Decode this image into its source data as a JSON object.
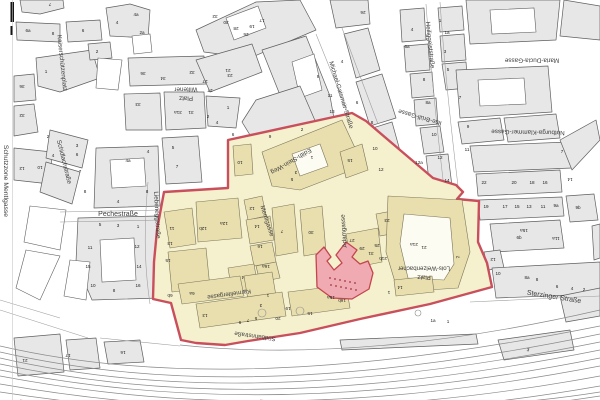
{
  "map": {
    "zone_name": "Schutzzone Mentlgasse",
    "colors": {
      "building_gray": "#e7e7e7",
      "outline": "#5f5f5f",
      "zone_fill": "#f5f1ce",
      "zone_building": "#e9dfae",
      "zone_outline": "#7b755a",
      "boundary": "#c94f5c",
      "highlight_fill": "#efaab2",
      "highlight_stroke": "#c4454f",
      "highlight_dot": "#a03540",
      "rail": "#8a8a8a",
      "label": "#3c3c3c"
    },
    "street_labels": [
      [
        "Schutzzone Mentlgasse",
        6,
        181,
        90,
        6.8
      ],
      [
        "Kaiserschützenplatz",
        62,
        63,
        84,
        6.3
      ],
      [
        "Wiltener",
        186,
        89,
        180,
        6.3
      ],
      [
        "Platz",
        186,
        98,
        180,
        6.3
      ],
      [
        "Schidlachstraße",
        64,
        162,
        76,
        6.3
      ],
      [
        "Pechestraße",
        118,
        214,
        0,
        7
      ],
      [
        "Liebeneggstraße",
        157,
        215,
        87,
        6.3
      ],
      [
        "Michael-Gaismair-Straße",
        341,
        95,
        73,
        6.3
      ],
      [
        "Heiliggeiststraße",
        430,
        45,
        84,
        6.3
      ],
      [
        "Maria-Ducia-Gasse",
        532,
        60,
        180,
        6.3
      ],
      [
        "Notburga-Klammer-Gasse",
        528,
        132,
        181,
        6.3
      ],
      [
        "Ilse-Brüll-Gasse",
        420,
        117,
        196,
        6.3
      ],
      [
        "Edith-Stein-Weg",
        291,
        161,
        150,
        6.3
      ],
      [
        "Mentlgasse",
        267,
        221,
        72,
        6.3
      ],
      [
        "Adamgasse",
        344,
        231,
        266,
        6.3
      ],
      [
        "Karmelitergasse",
        229,
        294,
        172,
        6.1
      ],
      [
        "Südbahnstraße",
        255,
        336,
        188,
        6.1
      ],
      [
        "Lois-Welzenbacher",
        424,
        268,
        180,
        6.1
      ],
      [
        "Platz",
        424,
        277,
        180,
        6.1
      ],
      [
        "Sterzinger Straße",
        554,
        297,
        9,
        7
      ]
    ],
    "house_numbers": [
      [
        "7",
        50,
        4,
        180
      ],
      [
        "6a",
        28,
        31,
        0
      ],
      [
        "8",
        53,
        34,
        0
      ],
      [
        "6",
        83,
        31,
        0
      ],
      [
        "4",
        117,
        23,
        0
      ],
      [
        "4a",
        136,
        15,
        0
      ],
      [
        "2a",
        142,
        33,
        0
      ],
      [
        "2",
        97,
        52,
        0
      ],
      [
        "1",
        46,
        72,
        0
      ],
      [
        "36",
        22,
        86,
        180
      ],
      [
        "32",
        22,
        115,
        180
      ],
      [
        "36",
        143,
        73,
        180
      ],
      [
        "34",
        163,
        78,
        180
      ],
      [
        "32",
        192,
        72,
        180
      ],
      [
        "33",
        138,
        104,
        180
      ],
      [
        "31a",
        178,
        112,
        180
      ],
      [
        "31",
        191,
        112,
        180
      ],
      [
        "27",
        210,
        90,
        180
      ],
      [
        "23",
        230,
        75,
        180
      ],
      [
        "1",
        228,
        108,
        0
      ],
      [
        "2",
        208,
        117,
        0
      ],
      [
        "4",
        217,
        123,
        0
      ],
      [
        "5",
        173,
        148,
        0
      ],
      [
        "7",
        177,
        167,
        0
      ],
      [
        "12",
        22,
        168,
        180
      ],
      [
        "10",
        40,
        167,
        180
      ],
      [
        "2",
        48,
        137,
        0
      ],
      [
        "3",
        77,
        146,
        0
      ],
      [
        "4",
        53,
        156,
        0
      ],
      [
        "6",
        77,
        155,
        0
      ],
      [
        "7",
        80,
        172,
        0
      ],
      [
        "8",
        85,
        192,
        0
      ],
      [
        "4a",
        128,
        161,
        0
      ],
      [
        "4",
        148,
        152,
        0
      ],
      [
        "8",
        147,
        192,
        0
      ],
      [
        "4",
        118,
        202,
        0
      ],
      [
        "32",
        215,
        16,
        180
      ],
      [
        "30",
        226,
        22,
        180
      ],
      [
        "28",
        236,
        28,
        180
      ],
      [
        "26",
        246,
        34,
        180
      ],
      [
        "27",
        205,
        81,
        180
      ],
      [
        "21",
        228,
        70,
        180
      ],
      [
        "19",
        252,
        26,
        180
      ],
      [
        "17",
        262,
        20,
        180
      ],
      [
        "2",
        302,
        130,
        0
      ],
      [
        "6",
        233,
        135,
        0
      ],
      [
        "9",
        270,
        137,
        0
      ],
      [
        "10",
        240,
        162,
        180
      ],
      [
        "26",
        363,
        12,
        180
      ],
      [
        "9",
        318,
        77,
        0
      ],
      [
        "11",
        330,
        96,
        0
      ],
      [
        "13",
        332,
        112,
        0
      ],
      [
        "4",
        342,
        62,
        0
      ],
      [
        "6",
        357,
        103,
        0
      ],
      [
        "8",
        372,
        123,
        0
      ],
      [
        "10",
        375,
        149,
        0
      ],
      [
        "12",
        381,
        170,
        0
      ],
      [
        "4",
        412,
        30,
        0
      ],
      [
        "6a",
        407,
        47,
        0
      ],
      [
        "8",
        424,
        80,
        0
      ],
      [
        "8a",
        428,
        103,
        0
      ],
      [
        "10",
        434,
        135,
        0
      ],
      [
        "12",
        440,
        158,
        0
      ],
      [
        "12a",
        419,
        163,
        0
      ],
      [
        "14",
        447,
        181,
        0
      ],
      [
        "1",
        440,
        21,
        0
      ],
      [
        "1a",
        447,
        33,
        0
      ],
      [
        "3",
        445,
        52,
        0
      ],
      [
        "5",
        448,
        70,
        0
      ],
      [
        "7",
        460,
        98,
        0
      ],
      [
        "9",
        468,
        127,
        0
      ],
      [
        "11",
        467,
        150,
        0
      ],
      [
        "7",
        562,
        152,
        0
      ],
      [
        "14",
        570,
        179,
        180
      ],
      [
        "22",
        484,
        183,
        0
      ],
      [
        "20",
        514,
        183,
        0
      ],
      [
        "18",
        532,
        183,
        0
      ],
      [
        "16",
        545,
        183,
        0
      ],
      [
        "19",
        486,
        207,
        0
      ],
      [
        "17",
        505,
        207,
        0
      ],
      [
        "15",
        517,
        207,
        0
      ],
      [
        "13",
        529,
        207,
        0
      ],
      [
        "11",
        543,
        207,
        0
      ],
      [
        "9a",
        556,
        206,
        0
      ],
      [
        "9b",
        578,
        208,
        0
      ],
      [
        "15a",
        524,
        230,
        180
      ],
      [
        "6b",
        519,
        238,
        0
      ],
      [
        "11a",
        556,
        238,
        180
      ],
      [
        "12",
        493,
        259,
        180
      ],
      [
        "10",
        498,
        274,
        0
      ],
      [
        "8a",
        527,
        278,
        0
      ],
      [
        "8",
        537,
        280,
        0
      ],
      [
        "6",
        557,
        287,
        0
      ],
      [
        "4",
        572,
        289,
        0
      ],
      [
        "2",
        584,
        290,
        0
      ],
      [
        "3",
        528,
        350,
        12
      ],
      [
        "1a",
        433,
        321,
        0
      ],
      [
        "1",
        448,
        322,
        0
      ],
      [
        "1",
        312,
        157,
        180
      ],
      [
        "3",
        296,
        172,
        180
      ],
      [
        "5",
        292,
        179,
        180
      ],
      [
        "15",
        350,
        160,
        180
      ],
      [
        "12",
        252,
        208,
        180
      ],
      [
        "14",
        257,
        226,
        180
      ],
      [
        "16",
        260,
        246,
        180
      ],
      [
        "16a",
        266,
        266,
        180
      ],
      [
        "4",
        243,
        277,
        180
      ],
      [
        "12a",
        224,
        223,
        180
      ],
      [
        "12b",
        203,
        228,
        180
      ],
      [
        "11",
        172,
        228,
        180
      ],
      [
        "13",
        170,
        243,
        180
      ],
      [
        "15",
        168,
        260,
        180
      ],
      [
        "7",
        282,
        231,
        180
      ],
      [
        "30",
        311,
        232,
        180
      ],
      [
        "6b",
        170,
        295,
        180
      ],
      [
        "6a",
        192,
        293,
        180
      ],
      [
        "13",
        205,
        315,
        180
      ],
      [
        "9",
        240,
        322,
        180
      ],
      [
        "7",
        248,
        320,
        180
      ],
      [
        "5",
        256,
        318,
        180
      ],
      [
        "3",
        261,
        305,
        180
      ],
      [
        "1",
        268,
        295,
        180
      ],
      [
        "20",
        278,
        318,
        180
      ],
      [
        "19",
        288,
        308,
        180
      ],
      [
        "15",
        310,
        313,
        180
      ],
      [
        "16b",
        342,
        300,
        180
      ],
      [
        "15a",
        331,
        297,
        180
      ],
      [
        "23",
        387,
        220,
        180
      ],
      [
        "25",
        377,
        245,
        180
      ],
      [
        "27",
        352,
        240,
        180
      ],
      [
        "29",
        362,
        248,
        180
      ],
      [
        "31",
        371,
        253,
        180
      ],
      [
        "21b",
        383,
        258,
        180
      ],
      [
        "21a",
        414,
        244,
        180
      ],
      [
        "21",
        424,
        247,
        180
      ],
      [
        "2",
        458,
        257,
        262
      ],
      [
        "14",
        400,
        287,
        180
      ],
      [
        "1",
        389,
        292,
        180
      ],
      [
        "21",
        25,
        360,
        180
      ],
      [
        "17",
        68,
        355,
        180
      ],
      [
        "16",
        123,
        352,
        180
      ],
      [
        "5",
        100,
        225,
        0
      ],
      [
        "3",
        118,
        226,
        0
      ],
      [
        "1",
        138,
        227,
        0
      ],
      [
        "11",
        90,
        248,
        0
      ],
      [
        "12",
        137,
        247,
        0
      ],
      [
        "15",
        88,
        267,
        0
      ],
      [
        "14",
        139,
        267,
        0
      ],
      [
        "10",
        93,
        286,
        0
      ],
      [
        "8",
        114,
        291,
        0
      ],
      [
        "16",
        138,
        286,
        0
      ]
    ]
  }
}
